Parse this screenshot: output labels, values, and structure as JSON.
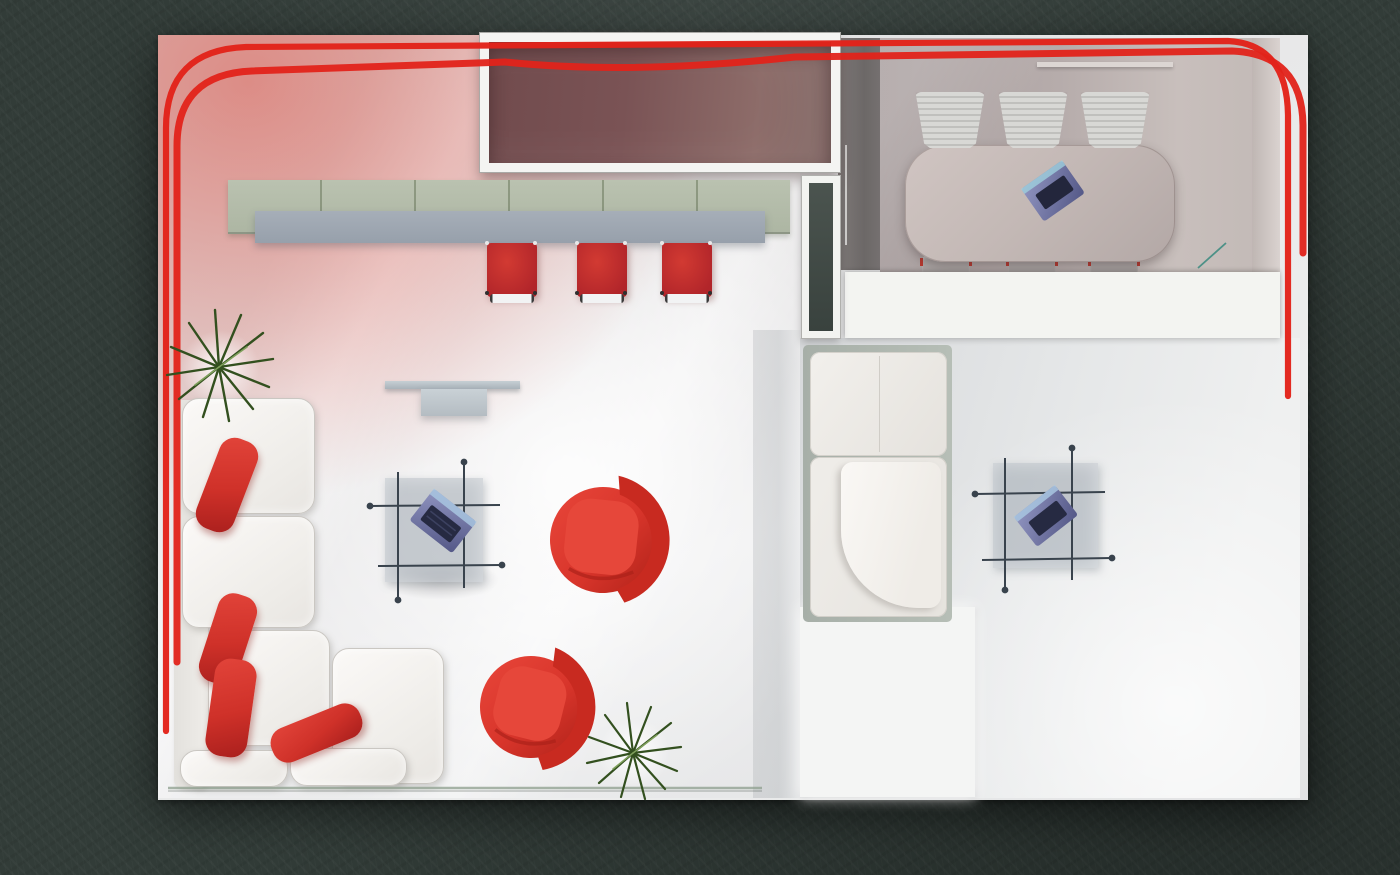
{
  "scene": {
    "description": "Top-down 3D architectural rendering of a modern office showroom floor plan on a dark concrete background",
    "view": "top-down render",
    "visible_text": "none"
  },
  "colors": {
    "bg": "#323c38",
    "ribbon": "#e2231a",
    "stool_red": "#b1252a",
    "pillow_red": "#cf3129",
    "tub_chair_red": "#d8352b",
    "sofa_white": "#f2f0ed",
    "counter_green": "#b3bcaa",
    "bar_gray": "#9aa3ae",
    "window_maroon": "#7a5355",
    "conference_floor": "#b4aaa9",
    "cabinet_dark": "#6e6a6a",
    "wall_white": "#f3f4f1",
    "laptop_purple": "#7f83b0",
    "plant_green": "#33501f",
    "table_gray": "#aab3bb",
    "floor_light": "#e7e7e8"
  },
  "areas": {
    "lounge_left": "open lounge with L-shaped sofa and red swivel chairs",
    "reception": "reception counter with sage-green panels and three red bar stools",
    "conference_room": "meeting room with oval table and six chairs",
    "lounge_right": "second lounge with corner seat and side table",
    "display_window": "white-framed maroon display window",
    "door": "white-framed door slot partition"
  },
  "furniture": {
    "red_ribbon": "decorative red ribbon line running along top, left and right edges",
    "bar_stools_count": 3,
    "conference_chairs_count": 6,
    "laptops_count": 3,
    "tub_chairs_count": 2,
    "plants_count": 2,
    "sofa_pillows_count": 4
  }
}
